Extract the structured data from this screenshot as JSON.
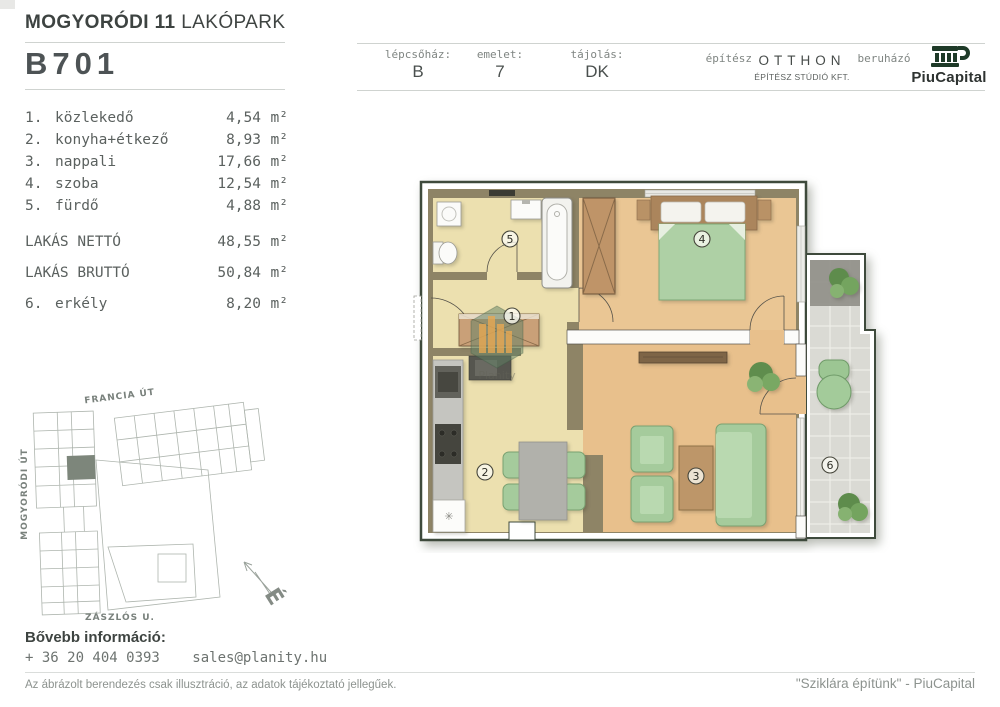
{
  "header": {
    "project_title_bold": "MOGYORÓDI 11",
    "project_title_light": "LAKÓPARK",
    "unit_id": "B701",
    "cells": [
      {
        "label": "lépcsőház:",
        "value": "B"
      },
      {
        "label": "emelet:",
        "value": "7"
      },
      {
        "label": "tájolás:",
        "value": "DK"
      }
    ],
    "architect": {
      "label": "építész",
      "name": "OTTHON",
      "sub": "ÉPÍTÉSZ STÚDIÓ KFT."
    },
    "developer": {
      "label": "beruházó",
      "name": "PiuCapital"
    }
  },
  "areas": {
    "rooms": [
      {
        "num": "1.",
        "name": "közlekedő",
        "value": "4,54",
        "unit": "m²"
      },
      {
        "num": "2.",
        "name": "konyha+étkező",
        "value": "8,93",
        "unit": "m²"
      },
      {
        "num": "3.",
        "name": "nappali",
        "value": "17,66",
        "unit": "m²"
      },
      {
        "num": "4.",
        "name": "szoba",
        "value": "12,54",
        "unit": "m²"
      },
      {
        "num": "5.",
        "name": "fürdő",
        "value": "4,88",
        "unit": "m²"
      }
    ],
    "net": {
      "name": "LAKÁS NETTÓ",
      "value": "48,55",
      "unit": "m²"
    },
    "gross": {
      "name": "LAKÁS BRUTTÓ",
      "value": "50,84",
      "unit": "m²"
    },
    "balcony": {
      "num": "6.",
      "name": "erkély",
      "value": "8,20",
      "unit": "m²"
    }
  },
  "floor_plan": {
    "labels": {
      "r1": "1",
      "r2": "2",
      "r3": "3",
      "r4": "4",
      "r5": "5",
      "r6": "6"
    },
    "watermark": "Planity",
    "fridge_symbol": "✳"
  },
  "site_plan": {
    "street_top": "FRANCIA ÚT",
    "street_left": "MOGYORÓDI ÚT",
    "street_bottom": "ZÁSZLÓS U.",
    "compass_letter": "É"
  },
  "contact": {
    "heading": "Bővebb információ:",
    "phone": "+ 36 20 404 0393",
    "email": "sales@planity.hu"
  },
  "footer": {
    "disclaimer": "Az ábrázolt berendezés csak illusztráció, az adatok tájékoztató jellegűek.",
    "slogan": "\"Sziklára építünk\" - PiuCapital"
  },
  "colors": {
    "wall_khaki": "#8e8466",
    "floor_warm_yellow": "#ece0af",
    "floor_wood_orange": "#e8c08c",
    "furniture_green": "#a5cb9c",
    "balcony_tile": "#dadad4",
    "logo_green": "#1e3a28",
    "line_gray": "#cfd3d0"
  }
}
